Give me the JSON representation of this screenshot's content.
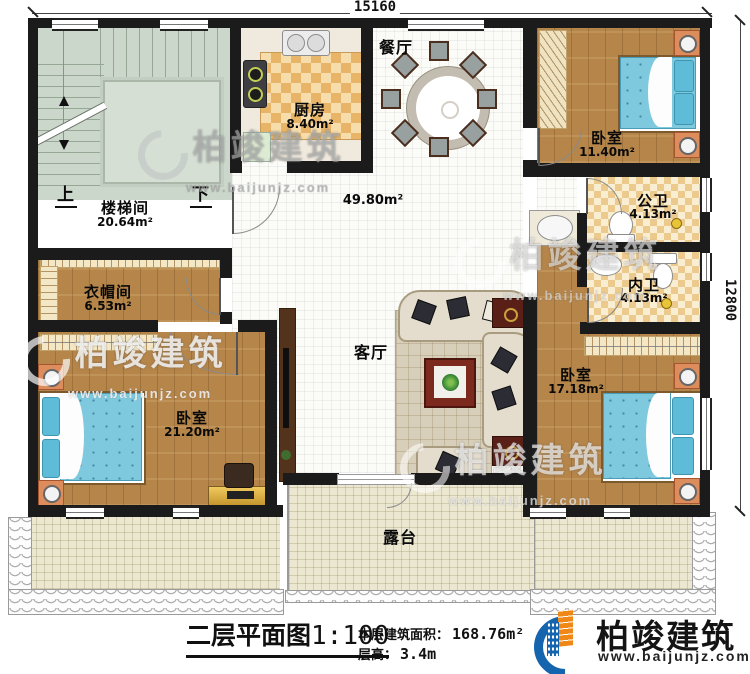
{
  "dimensions": {
    "width_label": "15160",
    "height_label": "12800"
  },
  "rooms": [
    {
      "name": "楼梯间",
      "area": "20.64m²"
    },
    {
      "name": "厨房",
      "area": "8.40m²"
    },
    {
      "name": "餐厅",
      "area": ""
    },
    {
      "name": "卧室",
      "area": "11.40m²"
    },
    {
      "name": "公卫",
      "area": "4.13m²"
    },
    {
      "name": "内卫",
      "area": "4.13m²"
    },
    {
      "name": "衣帽间",
      "area": "6.53m²"
    },
    {
      "name": "卧室",
      "area": "21.20m²"
    },
    {
      "name": "卧室",
      "area": "17.18m²"
    },
    {
      "name": "客厅",
      "area": "49.80m²"
    },
    {
      "name": "露台",
      "area": ""
    }
  ],
  "stairs": {
    "up": "上",
    "down": "下"
  },
  "title_block": {
    "title": "二层平面图",
    "scale": "1:100",
    "area_label": "本层建筑面积：",
    "area_value": "168.76m²",
    "floor_height_label": "层高：",
    "floor_height_value": "3.4m"
  },
  "brand": {
    "name": "柏竣建筑",
    "website": "www.baijunjz.com"
  },
  "watermark": {
    "name": "柏竣建筑",
    "website": "www.baijunjz.com"
  }
}
